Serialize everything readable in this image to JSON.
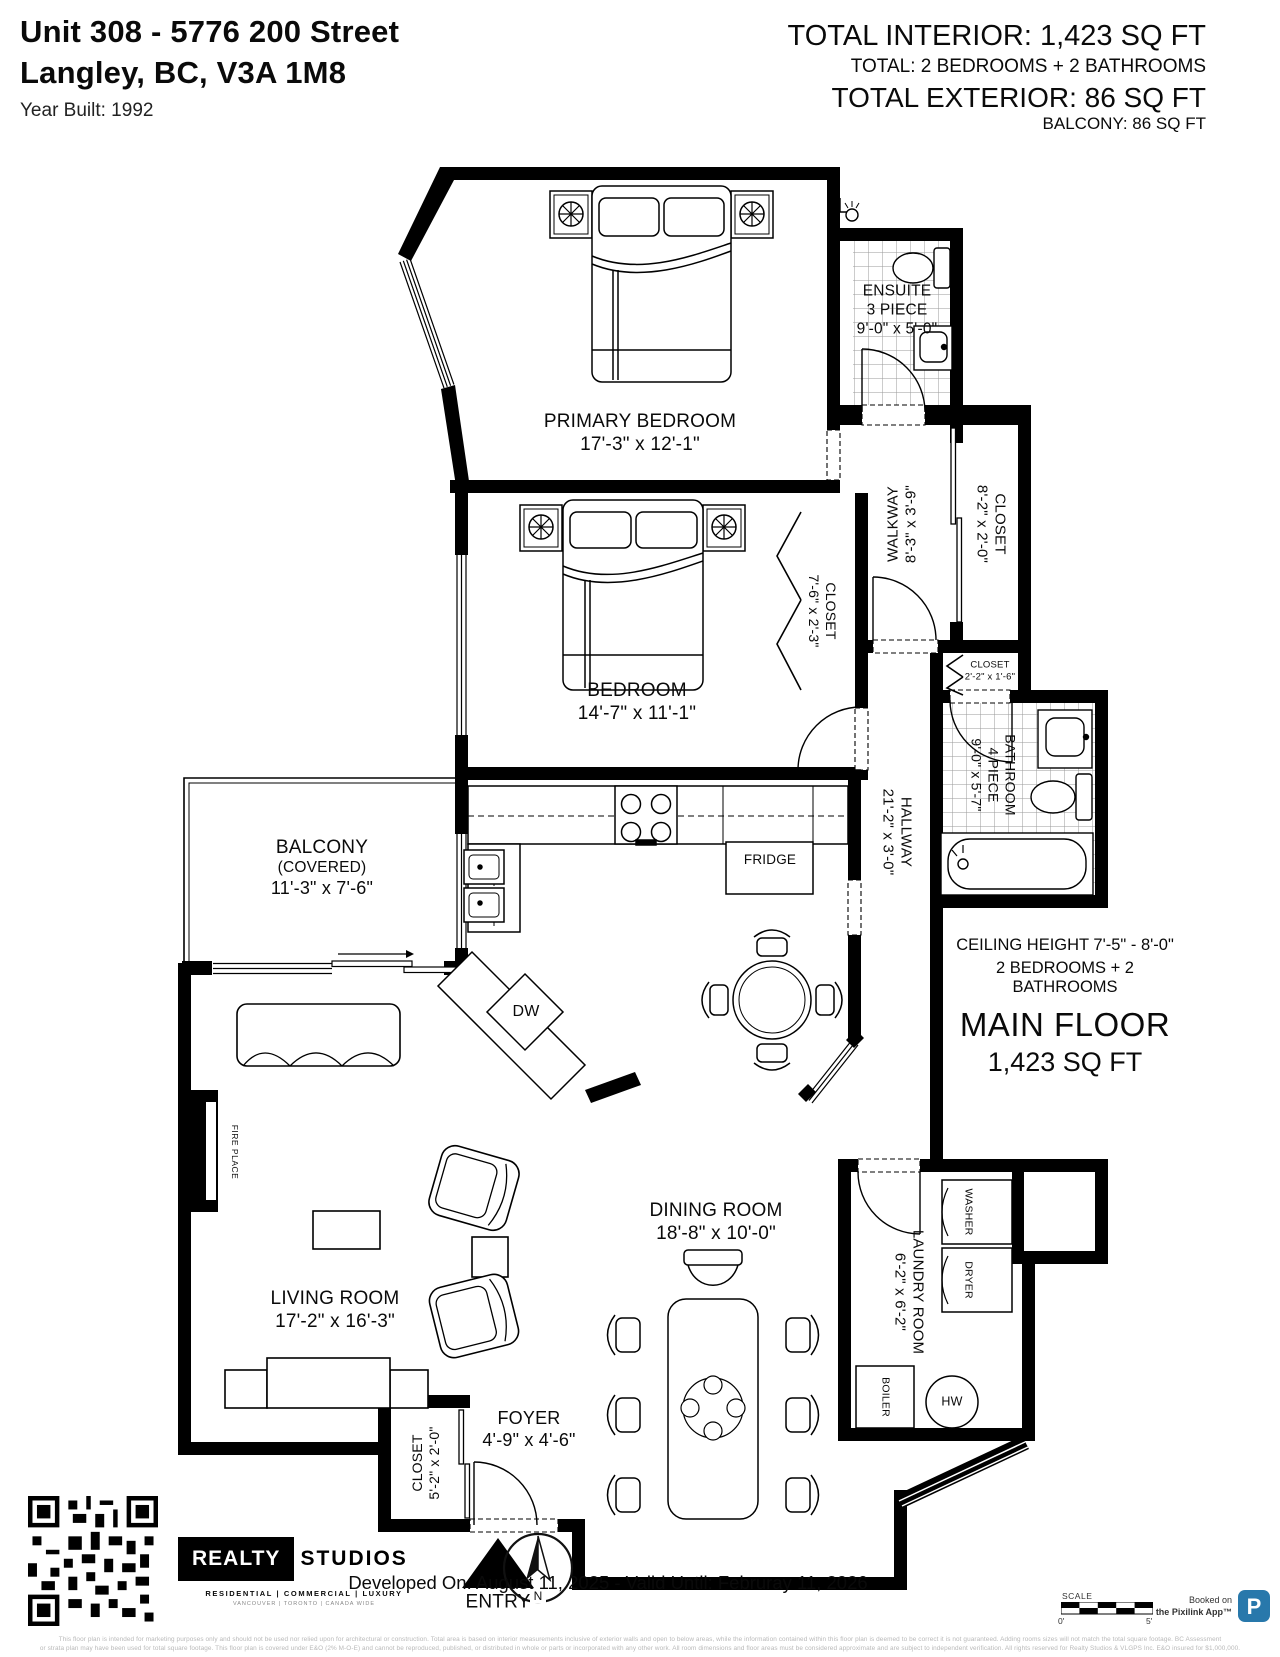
{
  "header": {
    "address_line1": "Unit 308 - 5776 200 Street",
    "address_line2": "Langley, BC, V3A 1M8",
    "year_built": "Year Built: 1992",
    "total_interior": "TOTAL INTERIOR: 1,423 SQ FT",
    "total_breakdown": "TOTAL: 2 BEDROOMS  + 2 BATHROOMS",
    "total_exterior": "TOTAL EXTERIOR: 86 SQ FT",
    "balcony_line": "BALCONY: 86 SQ FT"
  },
  "rooms": {
    "primary_bedroom": {
      "name": "PRIMARY BEDROOM",
      "dims": "17'-3\" x 12'-1\""
    },
    "ensuite": {
      "name": "ENSUITE",
      "type_line": "3 PIECE",
      "dims": "9'-0\" x 5'-0\""
    },
    "walkway": {
      "name": "WALKWAY",
      "dims": "8'-3\" x 3'-9\""
    },
    "closet_walkway": {
      "name": "CLOSET",
      "dims": "8'-2\" x 2'-0\""
    },
    "closet_hall": {
      "name": "CLOSET",
      "dims": "2'-2\" x 1'-6\""
    },
    "bedroom": {
      "name": "BEDROOM",
      "dims": "14'-7\" x 11'-1\""
    },
    "closet_bedroom": {
      "name": "CLOSET",
      "dims": "7'-6\" x 2'-3\""
    },
    "bathroom": {
      "name": "BATHROOM",
      "type_line": "4 PIECE",
      "dims": "9'-0\" x 5'-7\""
    },
    "hallway": {
      "name": "HALLWAY",
      "dims": "21'-2\" x 3'-0\""
    },
    "balcony": {
      "name": "BALCONY",
      "note": "(COVERED)",
      "dims": "11'-3\" x 7'-6\""
    },
    "living_room": {
      "name": "LIVING ROOM",
      "dims": "17'-2\" x 16'-3\""
    },
    "dining_room": {
      "name": "DINING ROOM",
      "dims": "18'-8\" x 10'-0\""
    },
    "laundry_room": {
      "name": "LAUNDRY ROOM",
      "dims": "6'-2\" x 6'-2\""
    },
    "foyer": {
      "name": "FOYER",
      "dims": "4'-9\" x 4'-6\""
    },
    "closet_foyer": {
      "name": "CLOSET",
      "dims": "5'-2\" x 2'-0\""
    }
  },
  "appliances": {
    "fridge": "FRIDGE",
    "dishwasher": "DW",
    "washer": "WASHER",
    "dryer": "DRYER",
    "boiler": "BOILER",
    "hot_water": "HW",
    "fireplace": "FIRE PLACE"
  },
  "plan": {
    "entry_label": "ENTRY"
  },
  "summary": {
    "ceiling_height": "CEILING HEIGHT 7'-5\" - 8'-0\"",
    "beds_baths": "2 BEDROOMS + 2 BATHROOMS",
    "floor_name": "MAIN FLOOR",
    "floor_area": "1,423 SQ FT"
  },
  "footer": {
    "brand_primary": "REALTY",
    "brand_secondary": "STUDIOS",
    "brand_tagline": "RESIDENTIAL | COMMERCIAL | LUXURY",
    "brand_subline": "VANCOUVER | TORONTO | CANADA WIDE",
    "compass_north": "N",
    "developed_line": "Developed On: August 11, 2025 - Valid Until: Februray 11, 2026",
    "scale_label": "SCALE",
    "scale_zero": "0'",
    "scale_five": "5'",
    "booked_line1": "Booked on",
    "booked_line2": "the Pixilink App™",
    "app_initial": "P",
    "disclaimer_line1": "This floor plan is intended for marketing purposes only and should not be used nor relied upon for architectural or construction. Total area is based on interior measurements inclusive of exterior walls and open to below areas, while the information contained within this floor plan is deemed to be correct it is not guaranteed. Adding rooms sizes will not match the total square footage. BC Assessment",
    "disclaimer_line2": "or strata plan may have been used for total square footage. This floor plan is covered under E&O (2% M-O-E) and cannot be reproduced, published, or distributed in whole or parts or incorporated with any other work. All room dimensions and floor areas must be considered approximate and are subject to independent verification. All rights reserved for Realty Studios & VLGPS Inc. E&O insured for $1,000,000."
  },
  "colors": {
    "app_blue": "#2878ab",
    "wall": "#000000"
  }
}
